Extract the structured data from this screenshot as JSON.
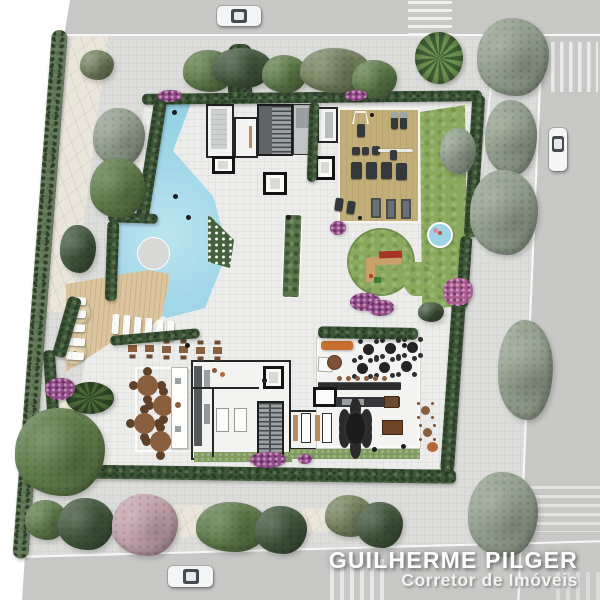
{
  "watermark": {
    "name": "GUILHERME PILGER",
    "subtitle": "Corretor de Imóveis"
  },
  "palette": {
    "page-bg": "#ffffff",
    "street": "#c7c8c6",
    "sidewalk": "#dcddda",
    "plaza": "#ecedeb",
    "pool": "#a3d8e8",
    "hedge": "#3d5638",
    "lawn": "#8aa95c",
    "wood-deck": "#dcc59e",
    "gym-floor": "#c3ae77",
    "stone-path": "#eae6db",
    "sand": "#e8e1ca",
    "furniture-brown": "#8a5f3e",
    "accent-orange": "#c86f2e",
    "playground-red": "#a63527",
    "equipment-dark": "#35393b"
  }
}
